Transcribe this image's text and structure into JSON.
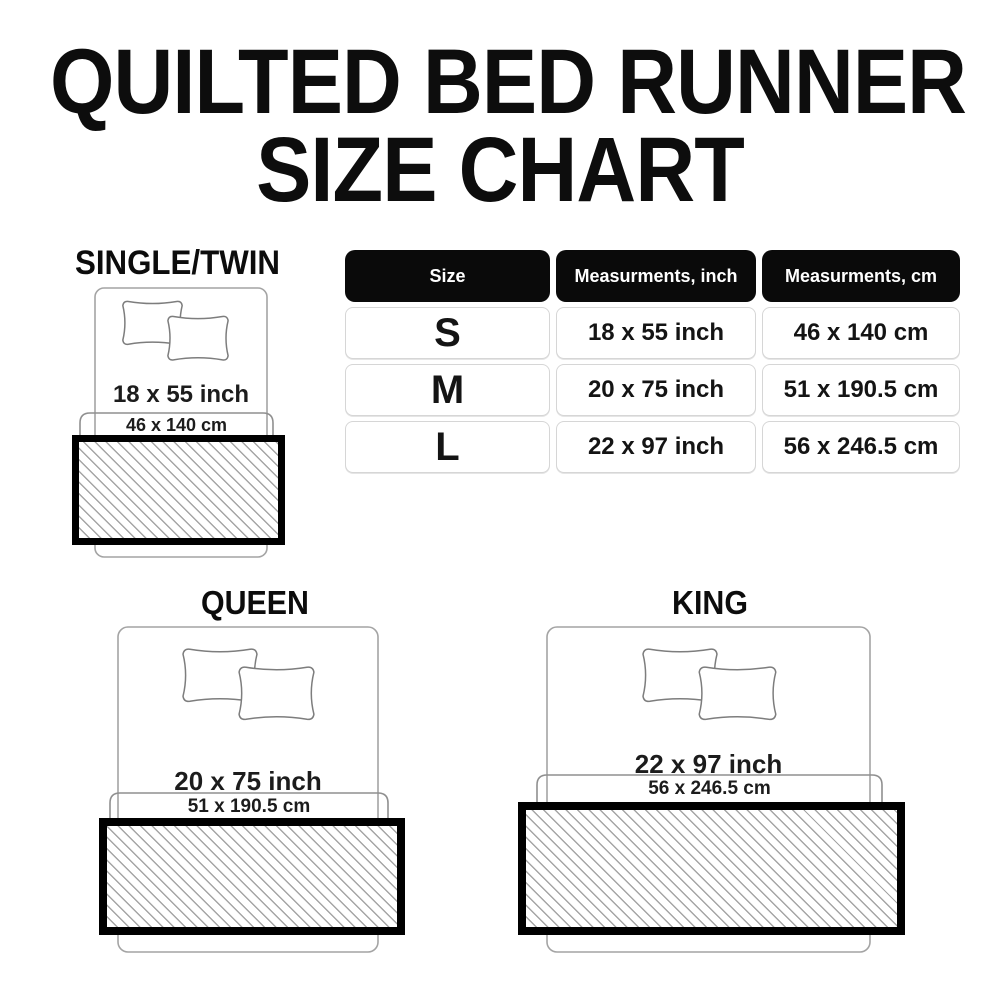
{
  "title": {
    "line1": "QUILTED BED RUNNER",
    "line2": "SIZE CHART"
  },
  "table": {
    "headers": [
      "Size",
      "Measurments, inch",
      "Measurments, cm"
    ],
    "rows": [
      {
        "size": "S",
        "inch": "18 x 55 inch",
        "cm": "46 x 140 cm"
      },
      {
        "size": "M",
        "inch": "20 x 75 inch",
        "cm": "51 x 190.5 cm"
      },
      {
        "size": "L",
        "inch": "22 x 97 inch",
        "cm": "56 x 246.5 cm"
      }
    ]
  },
  "diagrams": [
    {
      "name": "SINGLE/TWIN",
      "inch": "18 x 55 inch",
      "cm": "46 x 140 cm"
    },
    {
      "name": "QUEEN",
      "inch": "20 x 75 inch",
      "cm": "51 x 190.5 cm"
    },
    {
      "name": "KING",
      "inch": "22 x 97 inch",
      "cm": "56 x 246.5 cm"
    }
  ],
  "colors": {
    "header_bg": "#0a0a0a",
    "header_text": "#ffffff",
    "runner_border": "#000000",
    "hatch_line": "#a5a5a5",
    "bed_outline": "#a4a4a4",
    "text": "#111111"
  },
  "chart_data": {
    "type": "table",
    "title": "QUILTED BED RUNNER SIZE CHART",
    "columns": [
      "Size",
      "Measurments, inch",
      "Measurments, cm"
    ],
    "rows": [
      [
        "S",
        "18 x 55 inch",
        "46 x 140 cm"
      ],
      [
        "M",
        "20 x 75 inch",
        "51 x 190.5 cm"
      ],
      [
        "L",
        "22 x 97 inch",
        "56 x 246.5 cm"
      ]
    ]
  }
}
